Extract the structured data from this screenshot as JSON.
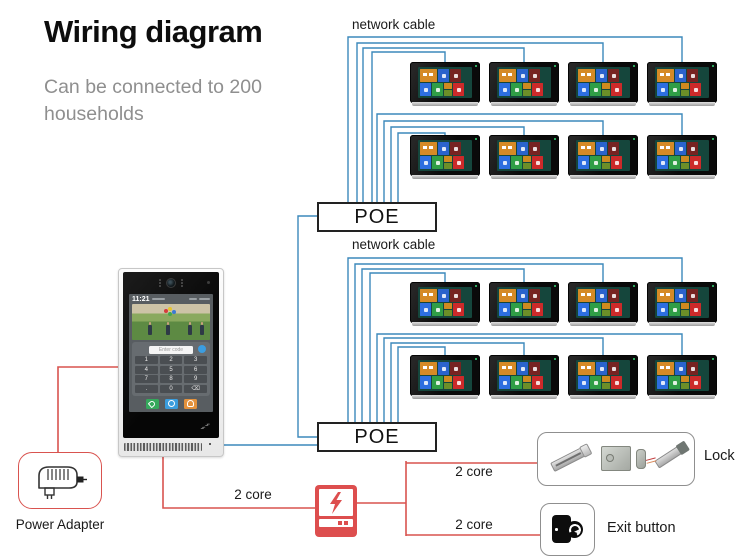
{
  "header": {
    "title": "Wiring diagram",
    "subtitle": "Can be connected to 200 households"
  },
  "colors": {
    "wire_blue": "#3c88bb",
    "wire_red": "#d9534f",
    "accent_red": "#dd4e4e",
    "box_border": "#8f8f8f",
    "poe_border": "#222222",
    "monitor_screen": "#15463c",
    "tile_orange": "#d58a26",
    "tile_blue": "#2a63cc",
    "tile_maroon": "#772321",
    "tile_blue2": "#2d6ee0",
    "tile_green": "#2f9e46",
    "tile_red": "#cc2a2a"
  },
  "network": {
    "label_top": "network cable",
    "label_mid": "network cable",
    "poe1_label": "POE",
    "poe2_label": "POE",
    "monitor_groups": [
      {
        "id": "group-1",
        "rows": 2,
        "cols": 4,
        "count": 8
      },
      {
        "id": "group-2",
        "rows": 2,
        "cols": 4,
        "count": 8
      }
    ]
  },
  "door_station": {
    "time": "11:21",
    "code_placeholder": "Enter code",
    "keypad": [
      "1",
      "2",
      "3",
      "4",
      "5",
      "6",
      "7",
      "8",
      "9",
      ".",
      "0",
      "⌫"
    ]
  },
  "peripherals": {
    "power_adapter_label": "Power Adapter",
    "lock_label": "Lock",
    "exit_button_label": "Exit button",
    "wire_door_to_psu": "2 core",
    "wire_psu_to_lock": "2 core",
    "wire_psu_to_exit": "2 core"
  }
}
